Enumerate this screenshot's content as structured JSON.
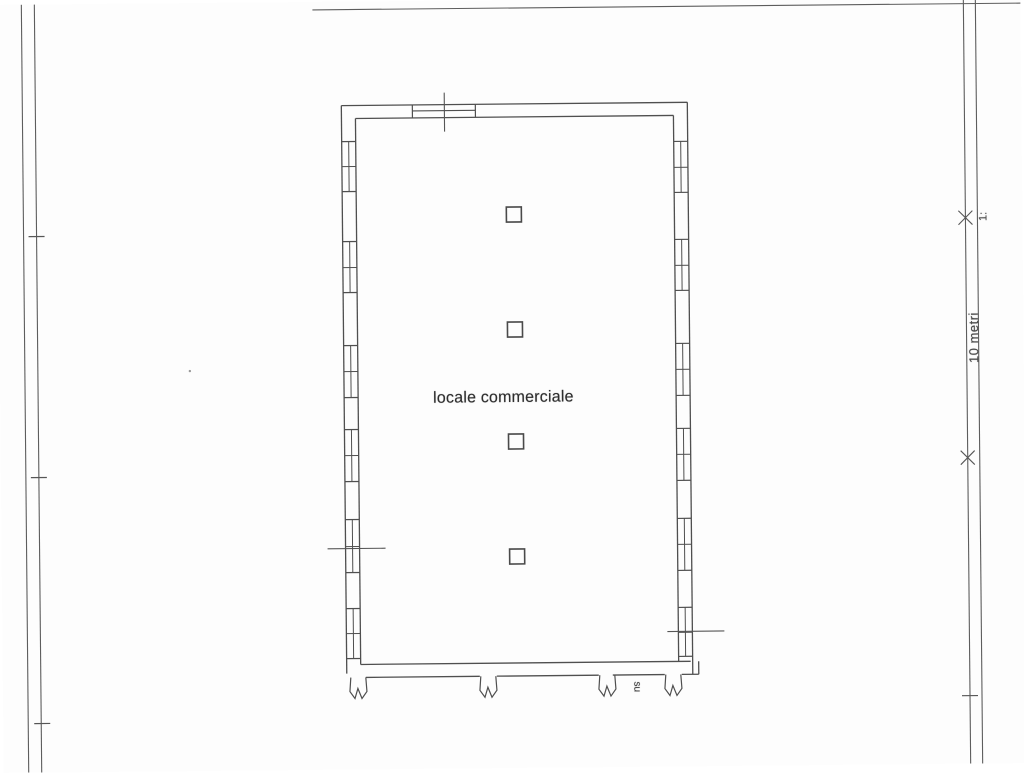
{
  "labels": {
    "room": "locale commerciale",
    "stair": "su",
    "dimension": "10 metri",
    "scale": "1:"
  },
  "colors": {
    "wall_line": "#4f4f4f",
    "border_line": "#5d5d5d",
    "mark_line": "#565656",
    "pillar_line": "#4a4a4a",
    "speck": "#9a9a9a",
    "paper": "#fdfdfd",
    "text": "#333333"
  },
  "plan": {
    "border_lines": [
      [
        25,
        0,
        25,
        768
      ],
      [
        38,
        0,
        38,
        768
      ],
      [
        967,
        0,
        967,
        768
      ],
      [
        979,
        0,
        979,
        768
      ],
      [
        316,
        8,
        1026,
        8
      ]
    ],
    "tick_lines": [
      [
        30,
        232,
        46,
        232
      ],
      [
        30,
        473,
        46,
        473
      ],
      [
        31,
        719,
        47,
        719
      ],
      [
        959,
        700,
        975,
        700
      ]
    ],
    "x_mark_lines": [
      [
        960,
        229,
        974,
        215
      ],
      [
        960,
        215,
        974,
        229
      ],
      [
        960,
        469,
        974,
        455
      ],
      [
        960,
        455,
        974,
        469
      ]
    ],
    "wall_lines": [
      [
        344,
        104,
        690,
        104
      ],
      [
        358,
        117,
        676,
        117
      ],
      [
        344,
        104,
        344,
        672
      ],
      [
        358,
        117,
        358,
        663
      ],
      [
        690,
        104,
        690,
        676
      ],
      [
        676,
        117,
        676,
        663
      ],
      [
        358,
        663,
        688,
        663
      ],
      [
        363,
        676,
        477,
        676
      ],
      [
        494,
        676,
        596,
        676
      ],
      [
        610,
        676,
        662,
        676
      ],
      [
        679,
        676,
        696,
        676
      ],
      [
        696,
        663,
        696,
        676
      ]
    ],
    "top_window": {
      "x1": 415,
      "x2": 478,
      "y1": 104,
      "y2": 117,
      "mid_y": 110
    },
    "section_lines": [
      [
        447,
        92,
        447,
        131
      ],
      [
        326,
        547,
        384,
        547
      ],
      [
        665,
        633,
        722,
        633
      ]
    ],
    "left_wall": {
      "x1": 344,
      "x2": 358,
      "center_x": 351
    },
    "right_wall": {
      "x1": 676,
      "x2": 690,
      "center_x": 683
    },
    "left_windows": [
      [
        140,
        190
      ],
      [
        240,
        291
      ],
      [
        344,
        396
      ],
      [
        428,
        480
      ],
      [
        518,
        571
      ],
      [
        607,
        657
      ]
    ],
    "right_windows": [
      [
        143,
        194
      ],
      [
        241,
        292
      ],
      [
        345,
        397
      ],
      [
        430,
        482
      ],
      [
        520,
        572
      ],
      [
        609,
        658
      ]
    ],
    "pillars": [
      [
        508,
        207
      ],
      [
        508,
        322
      ],
      [
        508,
        434
      ],
      [
        508,
        549
      ]
    ],
    "pillar_size": 15,
    "break_marks": [
      347,
      477,
      596,
      662
    ],
    "specks": [
      [
        190,
        368
      ]
    ]
  }
}
